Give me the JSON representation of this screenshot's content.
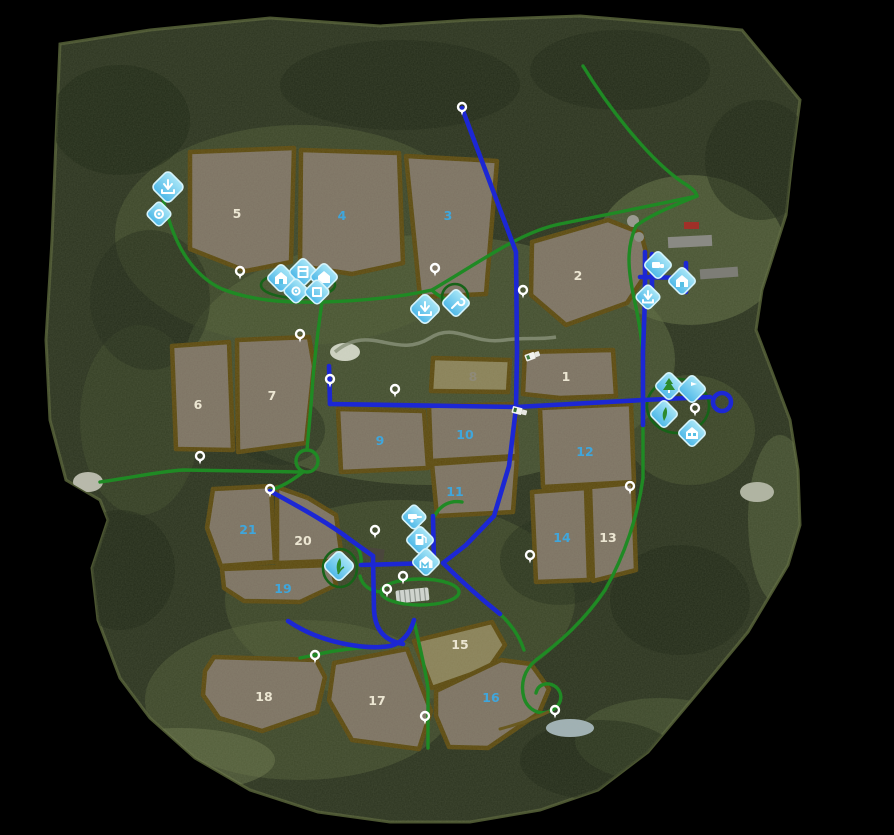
{
  "map": {
    "kind": "farming-game-map-overview",
    "fields": [
      {
        "number": "1",
        "status": "owned"
      },
      {
        "number": "2",
        "status": "owned"
      },
      {
        "number": "3",
        "status": "for_sale"
      },
      {
        "number": "4",
        "status": "for_sale"
      },
      {
        "number": "5",
        "status": "owned"
      },
      {
        "number": "6",
        "status": "owned"
      },
      {
        "number": "7",
        "status": "owned"
      },
      {
        "number": "8",
        "status": "owned_muted"
      },
      {
        "number": "9",
        "status": "for_sale"
      },
      {
        "number": "10",
        "status": "for_sale"
      },
      {
        "number": "11",
        "status": "for_sale"
      },
      {
        "number": "12",
        "status": "for_sale"
      },
      {
        "number": "13",
        "status": "owned"
      },
      {
        "number": "14",
        "status": "for_sale"
      },
      {
        "number": "15",
        "status": "owned"
      },
      {
        "number": "16",
        "status": "for_sale"
      },
      {
        "number": "17",
        "status": "owned"
      },
      {
        "number": "18",
        "status": "owned"
      },
      {
        "number": "19",
        "status": "for_sale"
      },
      {
        "number": "20",
        "status": "owned"
      },
      {
        "number": "21",
        "status": "for_sale"
      }
    ],
    "colors": {
      "background": "#000000",
      "forest": "#2b331f",
      "meadow": "#57643c",
      "field_fill": "#7d7263",
      "field_olive": "#8a8158",
      "field_border": "#5c490e",
      "road_blue": "#1c27d4",
      "road_green": "#1f8a24",
      "icon_fill": "#7fd6ee",
      "icon_border": "#d6f4fc",
      "label_owned": "#ece6d2",
      "label_for_sale": "#3fa6dc"
    },
    "icons": [
      {
        "name": "unload-point-icon",
        "glyph": "arrow-down-tray"
      },
      {
        "name": "production-icon",
        "glyph": "gear"
      },
      {
        "name": "cow-barn-icon",
        "glyph": "barn"
      },
      {
        "name": "silo-icon",
        "glyph": "box"
      },
      {
        "name": "storage-icon",
        "glyph": "barn"
      },
      {
        "name": "shop-icon",
        "glyph": "gear"
      },
      {
        "name": "warehouse-icon",
        "glyph": "box"
      },
      {
        "name": "unload-point-icon-2",
        "glyph": "arrow-down-tray"
      },
      {
        "name": "workshop-icon",
        "glyph": "wrench"
      },
      {
        "name": "vehicle-dealer-icon",
        "glyph": "truck"
      },
      {
        "name": "farm-supply-icon",
        "glyph": "barn"
      },
      {
        "name": "sell-station-icon",
        "glyph": "arrow-down-tray"
      },
      {
        "name": "sawmill-icon",
        "glyph": "tree"
      },
      {
        "name": "info-point-icon",
        "glyph": "flag"
      },
      {
        "name": "garden-center-icon",
        "glyph": "leaf"
      },
      {
        "name": "barn-sale-icon",
        "glyph": "barn"
      },
      {
        "name": "trailer-shop-icon",
        "glyph": "trailer"
      },
      {
        "name": "fuel-station-icon",
        "glyph": "pump"
      },
      {
        "name": "animal-barn-icon",
        "glyph": "barn"
      },
      {
        "name": "greenhouse-icon",
        "glyph": "leaf"
      }
    ],
    "markers_count": 17,
    "vehicles_count": 2
  }
}
